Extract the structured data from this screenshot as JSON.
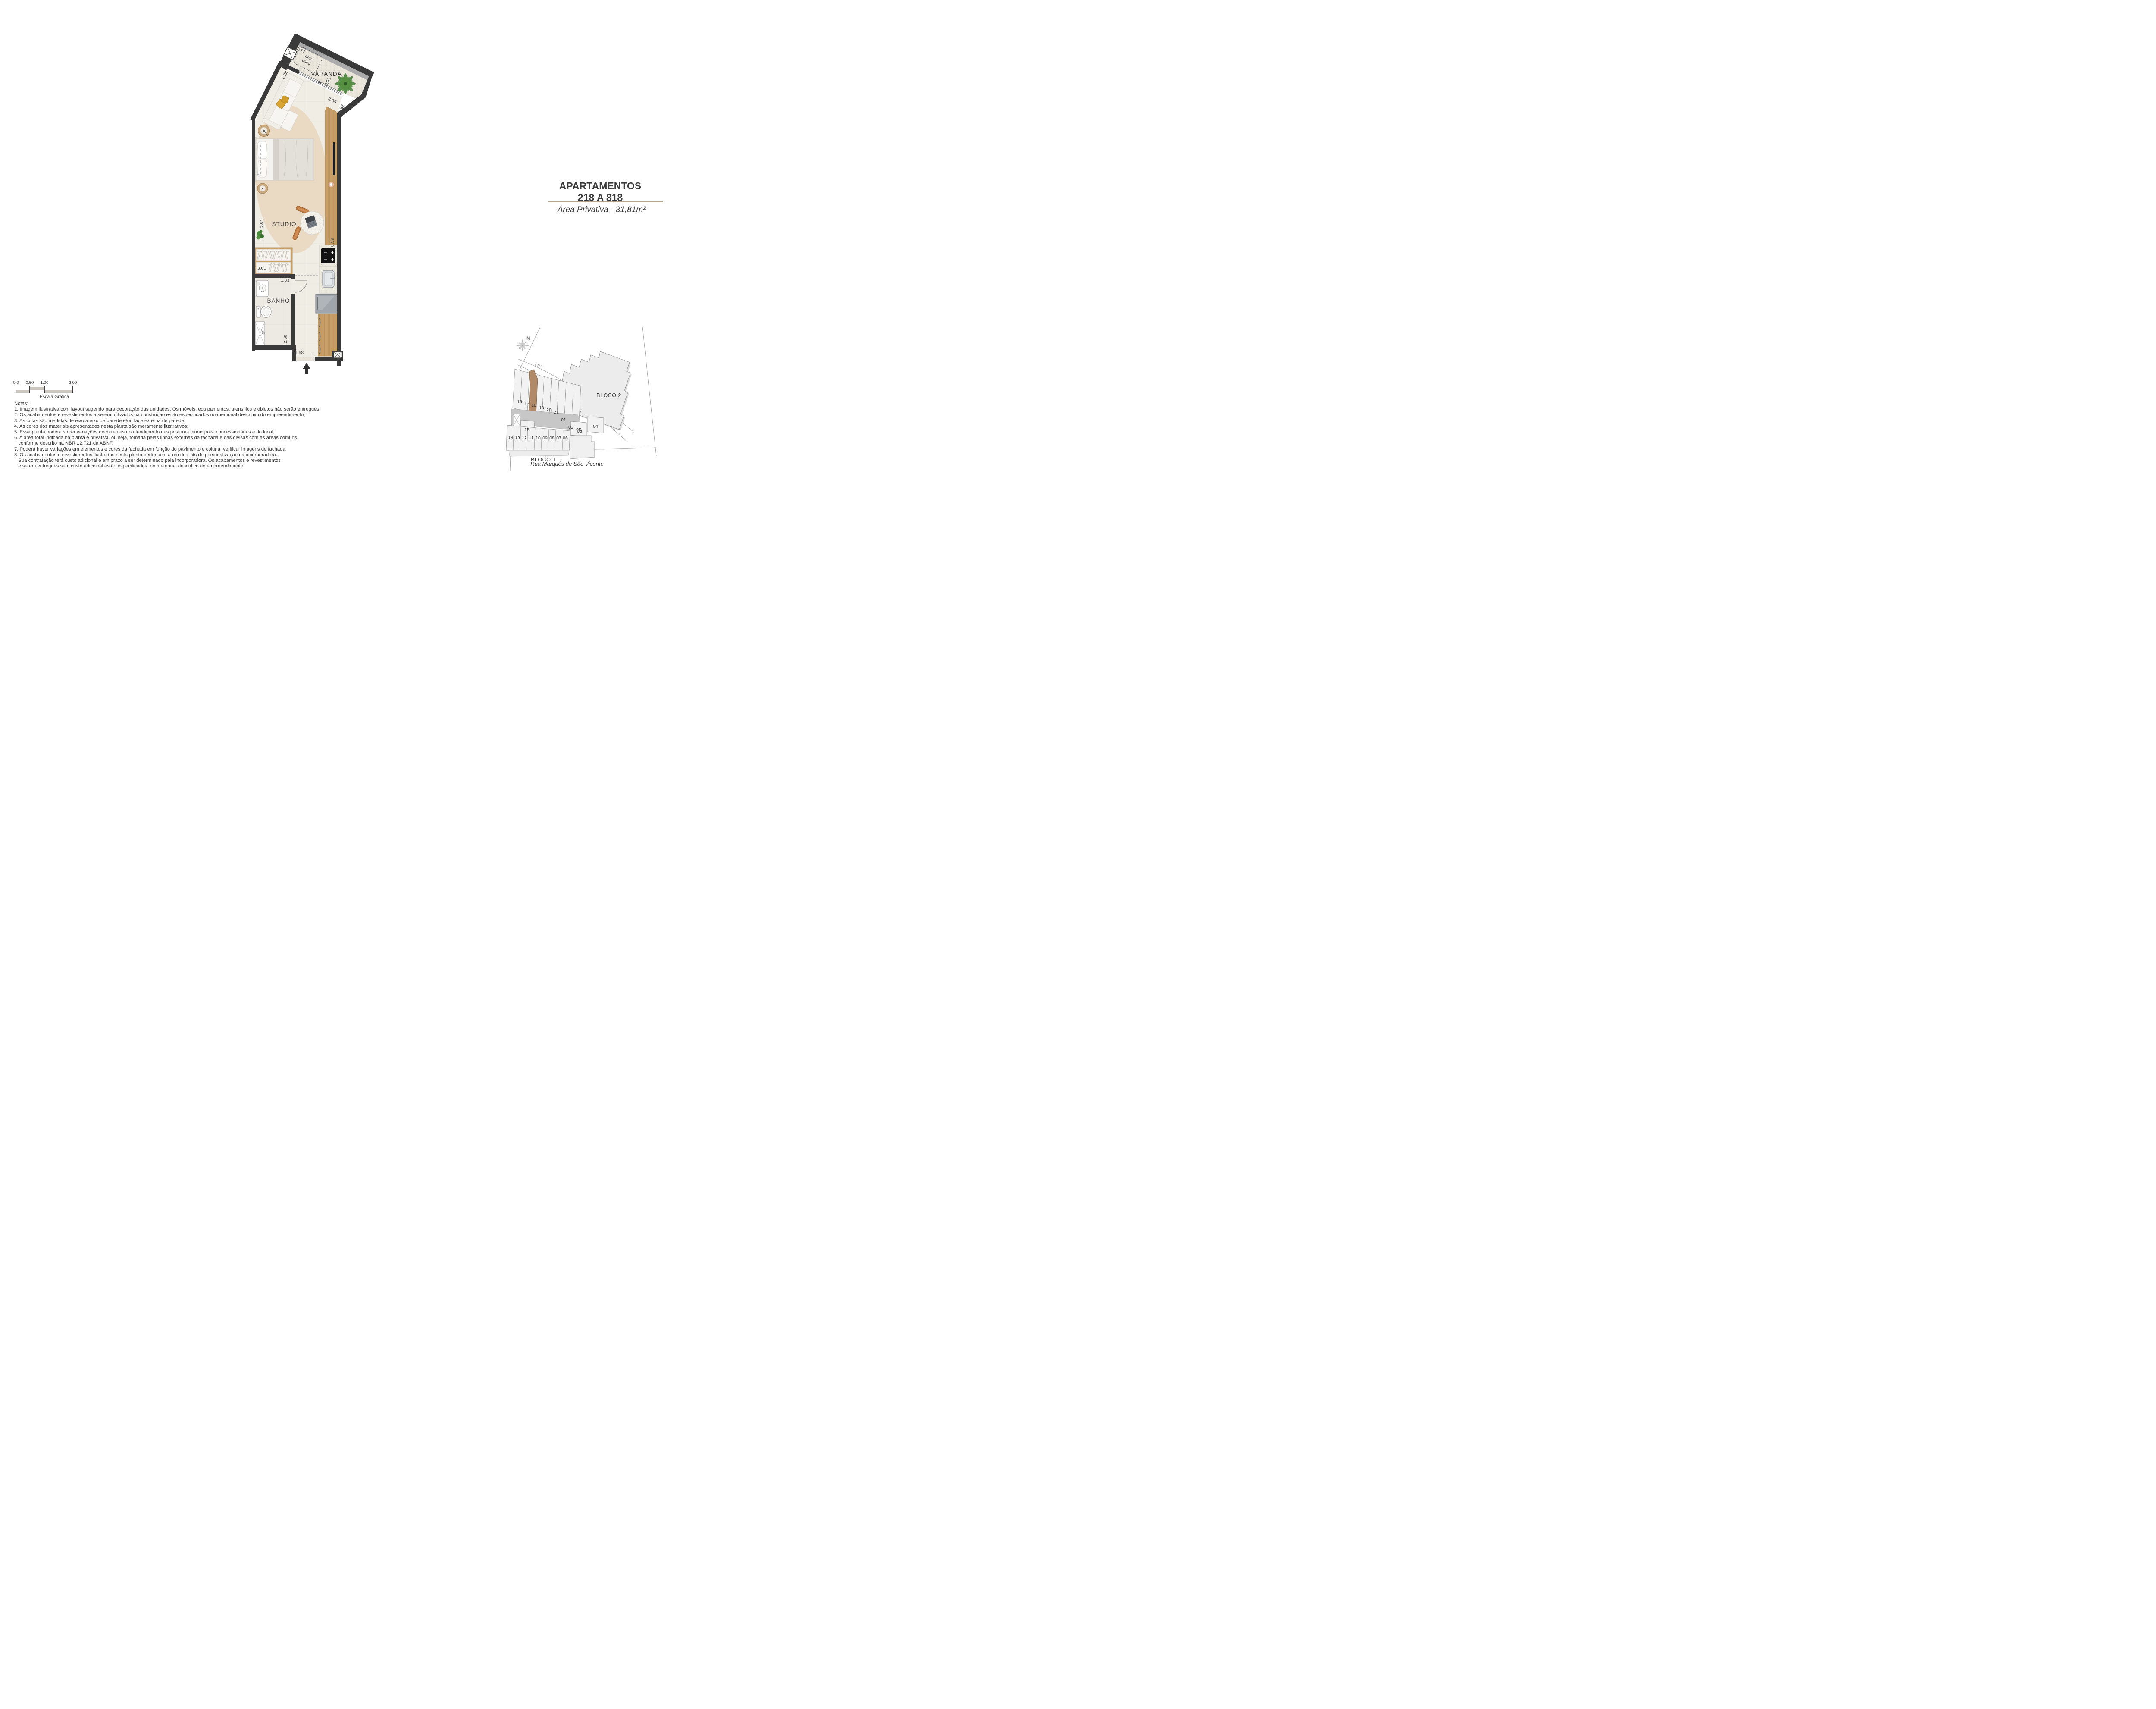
{
  "title": {
    "line1": "APARTAMENTOS",
    "line2": "218 A 818",
    "area": "Área Privativa - 31,81m²"
  },
  "floorplan": {
    "rooms": {
      "varanda": "VARANDA",
      "studio": "STUDIO",
      "banho": "BANHO"
    },
    "proj": {
      "line1": "proj.",
      "line2": "cond."
    },
    "dimensions": {
      "d277": "2.77",
      "d228": "2.28",
      "d093": "0.93",
      "d265": "2.65",
      "d082": "0.82",
      "d564": "5.64",
      "d859": "8.59",
      "d301": "3.01",
      "d133": "1.33",
      "d260": "2.60",
      "d168": "1.68"
    }
  },
  "scalebar": {
    "ticks": [
      "0.0",
      "0.50",
      "1.00",
      "2.00"
    ],
    "caption": "Escala Gráfica"
  },
  "notes": {
    "heading": "Notas:",
    "items": [
      "1. Imagem ilustrativa com layout sugerido para decoração das unidades. Os móveis, equipamentos, utensílios e objetos não serão entregues;",
      "2. Os acabamentos e revestimentos a serem utilizados na construção estão especificados no memorial descritivo do empreendimento;",
      "3. As cotas são medidas de eixo a eixo de parede e/ou face externa de parede;",
      "4. As cores dos materiais apresentados nesta planta são meramente ilustrativos;",
      "5. Essa planta poderá sofrer variações decorrentes do atendimento das posturas municipais, concessionárias e do local;",
      "6. A área total indicada na planta é privativa, ou seja, tomada pelas linhas externas da fachada e das divisas com as áreas comuns,",
      "   conforme descrito na NBR 12.721 da ABNT;",
      "7. Poderá haver variações em elementos e cores da fachada em função do pavimento e coluna, verificar imagens de fachada.",
      "8. Os acabamentos e revestimentos ilustrados nesta planta pertencem a um dos kits de personalização da incorporadora.",
      "   Sua contratação terá custo adicional e em prazo a ser determinado pela incorporadora. Os acabamentos e revestimentos",
      "   e serem entregues sem custo adicional estão especificados  no memorial descritivo do empreendimento."
    ]
  },
  "siteplan": {
    "north": "N",
    "road": "FNA",
    "bloco2": "BLOCO 2",
    "bloco1": "BLOCO 1",
    "street": "Rua Marquês de São Vicente",
    "highlighted_unit": "18",
    "units_top": [
      "16",
      "17",
      "18",
      "19",
      "20",
      "21",
      "01",
      "02",
      "03"
    ],
    "unit_15": "15",
    "units_bottom": [
      "14",
      "13",
      "12",
      "11",
      "10",
      "09",
      "08",
      "07",
      "06"
    ],
    "unit_05": "05",
    "unit_04": "04"
  },
  "colors": {
    "wall": "#3a3a3a",
    "wood": "#c79e66",
    "highlight_unit": "#b08968",
    "divider": "#b3a08b",
    "rug": "#e9d8c1",
    "pillow_accent": "#d9a634"
  }
}
